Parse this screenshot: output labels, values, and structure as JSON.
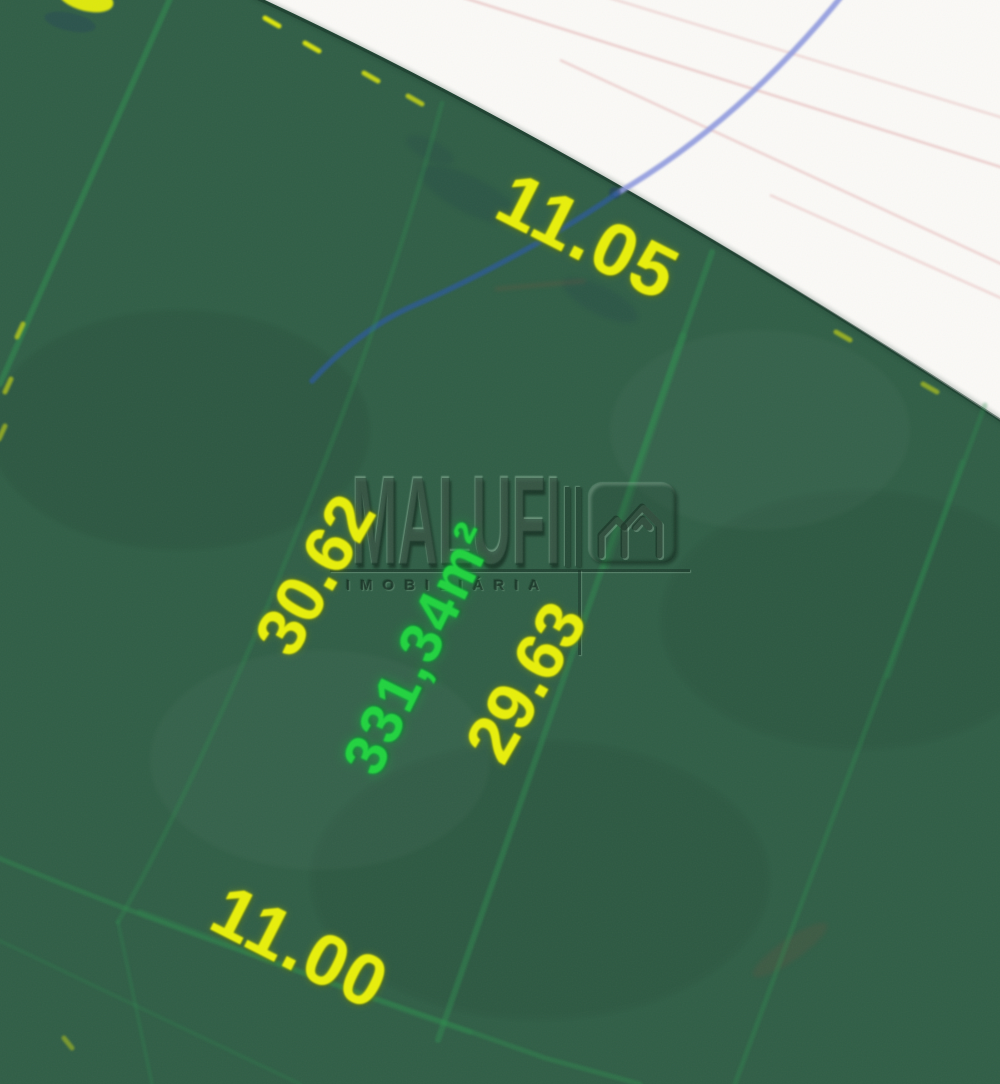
{
  "lot": {
    "frontage_top": "11.05",
    "side_left": "30.62",
    "side_right": "29.63",
    "frontage_bottom": "11.00",
    "area": "331,34m²"
  },
  "watermark": {
    "name": "MALUFI",
    "subtitle": "IMOBILIÁRIA",
    "icon": "house-icon"
  },
  "colors": {
    "bg_green": "#305e46",
    "road_white": "#fbfaf7",
    "dim_yellow": "#e8ef0a",
    "area_green": "#21d33f",
    "lot_line_green": "#2f9150",
    "boundary_edge": "#143326",
    "blue_road_line": "#8f9adf",
    "blue_green_line": "#2b5a96",
    "pink_line": "#dc9b9b"
  }
}
